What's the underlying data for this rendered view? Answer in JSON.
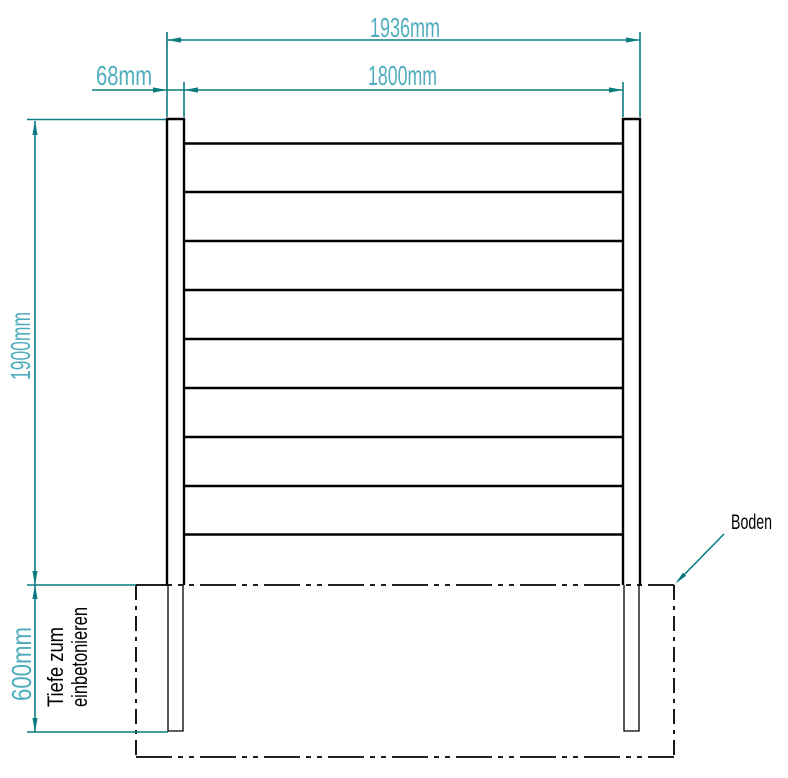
{
  "drawing": {
    "kind": "fence-panel-technical-drawing",
    "dimensions": {
      "total_width": "1936mm",
      "panel_width": "1800mm",
      "post_width": "68mm",
      "height_above_ground": "1900mm",
      "embed_depth": "600mm"
    },
    "annotations": {
      "depth_note_line1": "Tiefe zum",
      "depth_note_line2": "einbetonieren",
      "ground_label": "Boden"
    },
    "colors": {
      "dimension_line": "#0a7b7e",
      "dimension_text": "#4fadbd",
      "object_line": "#000000",
      "background": "#ffffff"
    },
    "board_count": 8,
    "post_count": 2
  }
}
